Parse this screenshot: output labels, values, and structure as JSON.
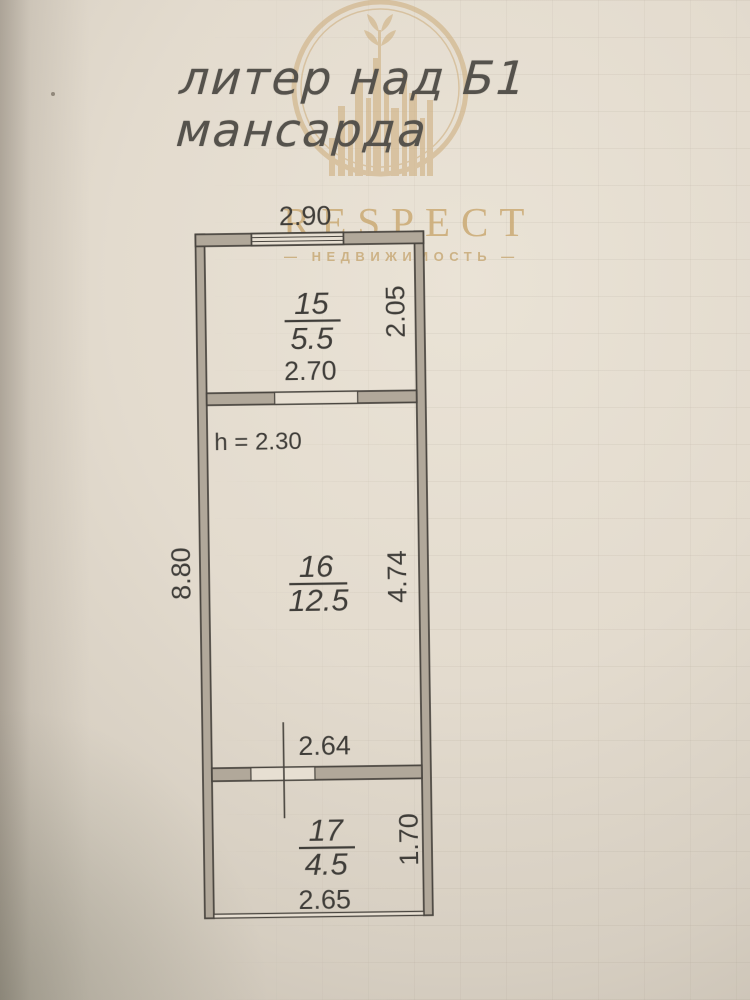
{
  "page": {
    "title_line1": "литер над Б1",
    "title_line2": "мансарда"
  },
  "watermark": {
    "brand": "RESPECT",
    "subtitle": "— НЕДВИЖИМОСТЬ —",
    "gold": "#c9ab78"
  },
  "plan": {
    "dim_top": "2.90",
    "dim_left": "8.80",
    "room15": {
      "number": "15",
      "area": "5.5",
      "dim_width": "2.70",
      "dim_height": "2.05"
    },
    "room16": {
      "number": "16",
      "area": "12.5",
      "dim_height": "4.74",
      "ceiling": "h = 2.30",
      "dim_bottom": "2.64"
    },
    "room17": {
      "number": "17",
      "area": "4.5",
      "dim_width": "2.65",
      "dim_height": "1.70"
    }
  },
  "colors": {
    "ink": "#3f3d39",
    "wall_fill": "#b1a89a",
    "paper_light": "#e8e1d4",
    "paper_dark": "#a79d90",
    "gold": "#c9ab78"
  }
}
